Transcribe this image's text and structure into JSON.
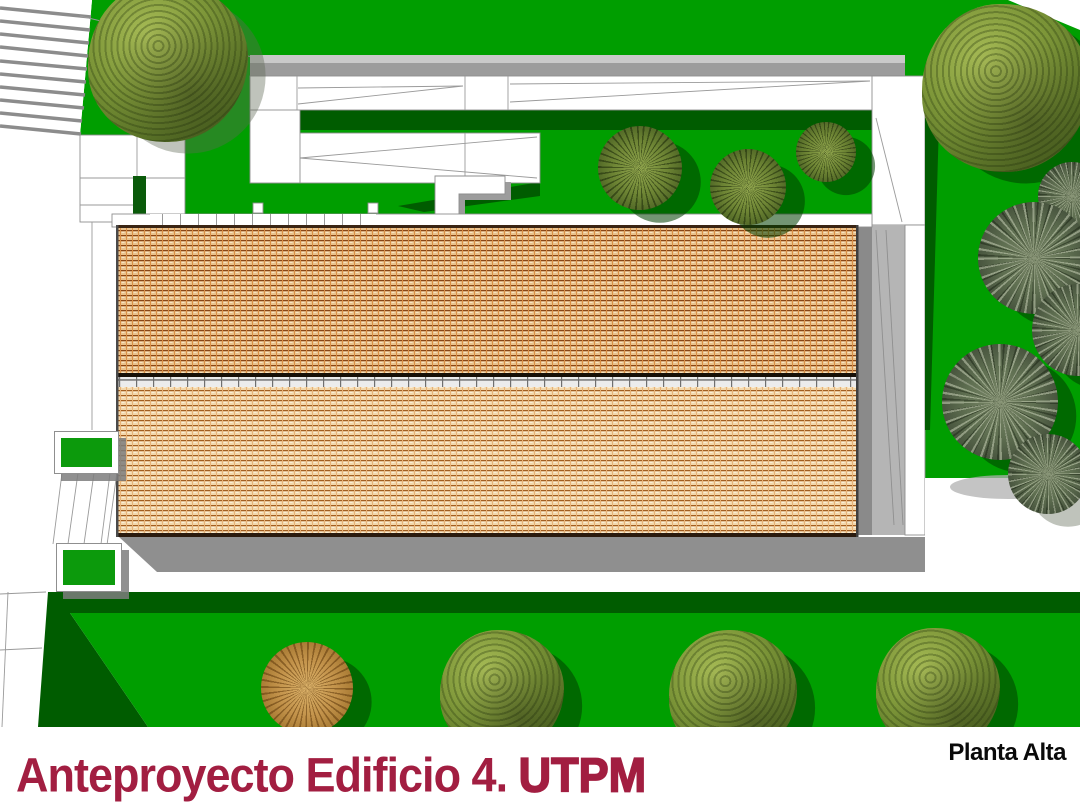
{
  "page": {
    "title_main": "Anteproyecto Edificio 4. ",
    "title_suffix": "UTPM",
    "corner_label": "Planta Alta"
  },
  "colors": {
    "grass": "#009e00",
    "grass_shade": "#005c00",
    "grass_deep": "#0a5a0a",
    "planter_green": "#0c9a0c",
    "ramp_gray": "#9c9c9c",
    "ramp_gray_light": "#c9c9c9",
    "wall_gray": "#8a8a8a",
    "side_gray": "#b5b5b5",
    "shadow_gray": "#8f8f8f",
    "outline": "#8e8e8e",
    "roof_edge": "#3a2413",
    "title_color": "#a21e41",
    "label_color": "#0a0a0a"
  },
  "scene": {
    "trees": [
      {
        "type": "broadleaf",
        "x": 168,
        "y": 62,
        "r": 80,
        "s": "soft"
      },
      {
        "type": "broadleaf",
        "x": 1006,
        "y": 88,
        "r": 84
      },
      {
        "type": "palm",
        "x": 640,
        "y": 168,
        "r": 42
      },
      {
        "type": "palm",
        "x": 748,
        "y": 187,
        "r": 38
      },
      {
        "type": "palm",
        "x": 826,
        "y": 152,
        "r": 30
      },
      {
        "type": "fern",
        "x": 1072,
        "y": 196,
        "r": 34
      },
      {
        "type": "fern",
        "x": 1034,
        "y": 258,
        "r": 56
      },
      {
        "type": "fern",
        "x": 1078,
        "y": 330,
        "r": 46
      },
      {
        "type": "fern",
        "x": 1000,
        "y": 402,
        "r": 58
      },
      {
        "type": "fern",
        "x": 1048,
        "y": 474,
        "r": 40,
        "s": "soft"
      },
      {
        "type": "palm_orange",
        "x": 307,
        "y": 688,
        "r": 46
      },
      {
        "type": "broadleaf",
        "x": 502,
        "y": 692,
        "r": 62
      },
      {
        "type": "broadleaf",
        "x": 733,
        "y": 694,
        "r": 64
      },
      {
        "type": "broadleaf",
        "x": 938,
        "y": 690,
        "r": 62
      }
    ],
    "planters": [
      {
        "x": 54,
        "y": 431,
        "w": 63,
        "h": 41
      },
      {
        "x": 56,
        "y": 543,
        "w": 64,
        "h": 47
      }
    ]
  }
}
